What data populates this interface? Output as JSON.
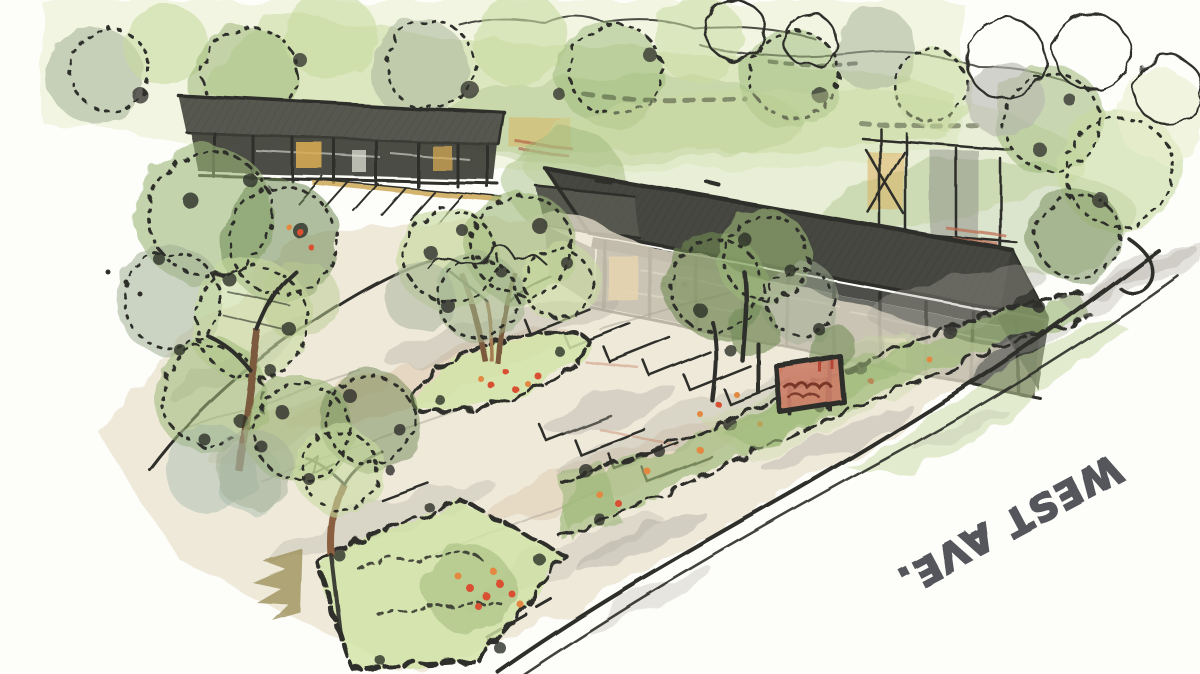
{
  "artwork": {
    "alt": "Hand-drawn aerial perspective marker-and-watercolor sketch of a retail site: two long dark-roofed single-story buildings, a tree-lined parking lot with planted islands, a flowering street hedge, a small monument sign with illegible lettering, and a street along the lower right labeled WEST AVE. written upside down.",
    "street_label": "WEST AVE."
  },
  "palette": {
    "paper": "#fdfdfa",
    "ink": "#2e2f29",
    "roof": "#45473f",
    "roof-light": "#575950",
    "facade": "#3c3e37",
    "glass": "#5b5d55",
    "amber": "#dcae55",
    "pave": "#e9e2cf",
    "pave-warm": "#d9c2a4",
    "pave-gray": "#a9a69b",
    "fol-pale": "#e9efcd",
    "fol-light": "#c8daa0",
    "fol-mid": "#9cb878",
    "fol-deep": "#6f8a54",
    "fol-gray": "#a3b096",
    "teal-wash": "#9cb3a4",
    "trunk": "#7b5a3d",
    "trunk-light": "#a67c52",
    "olive": "#9a8d55",
    "bloom-red": "#d84f33",
    "bloom-orange": "#e2883f",
    "sign-face": "#cc7f68",
    "sign-ink": "#6b2a1e",
    "marker": "#55565c"
  }
}
